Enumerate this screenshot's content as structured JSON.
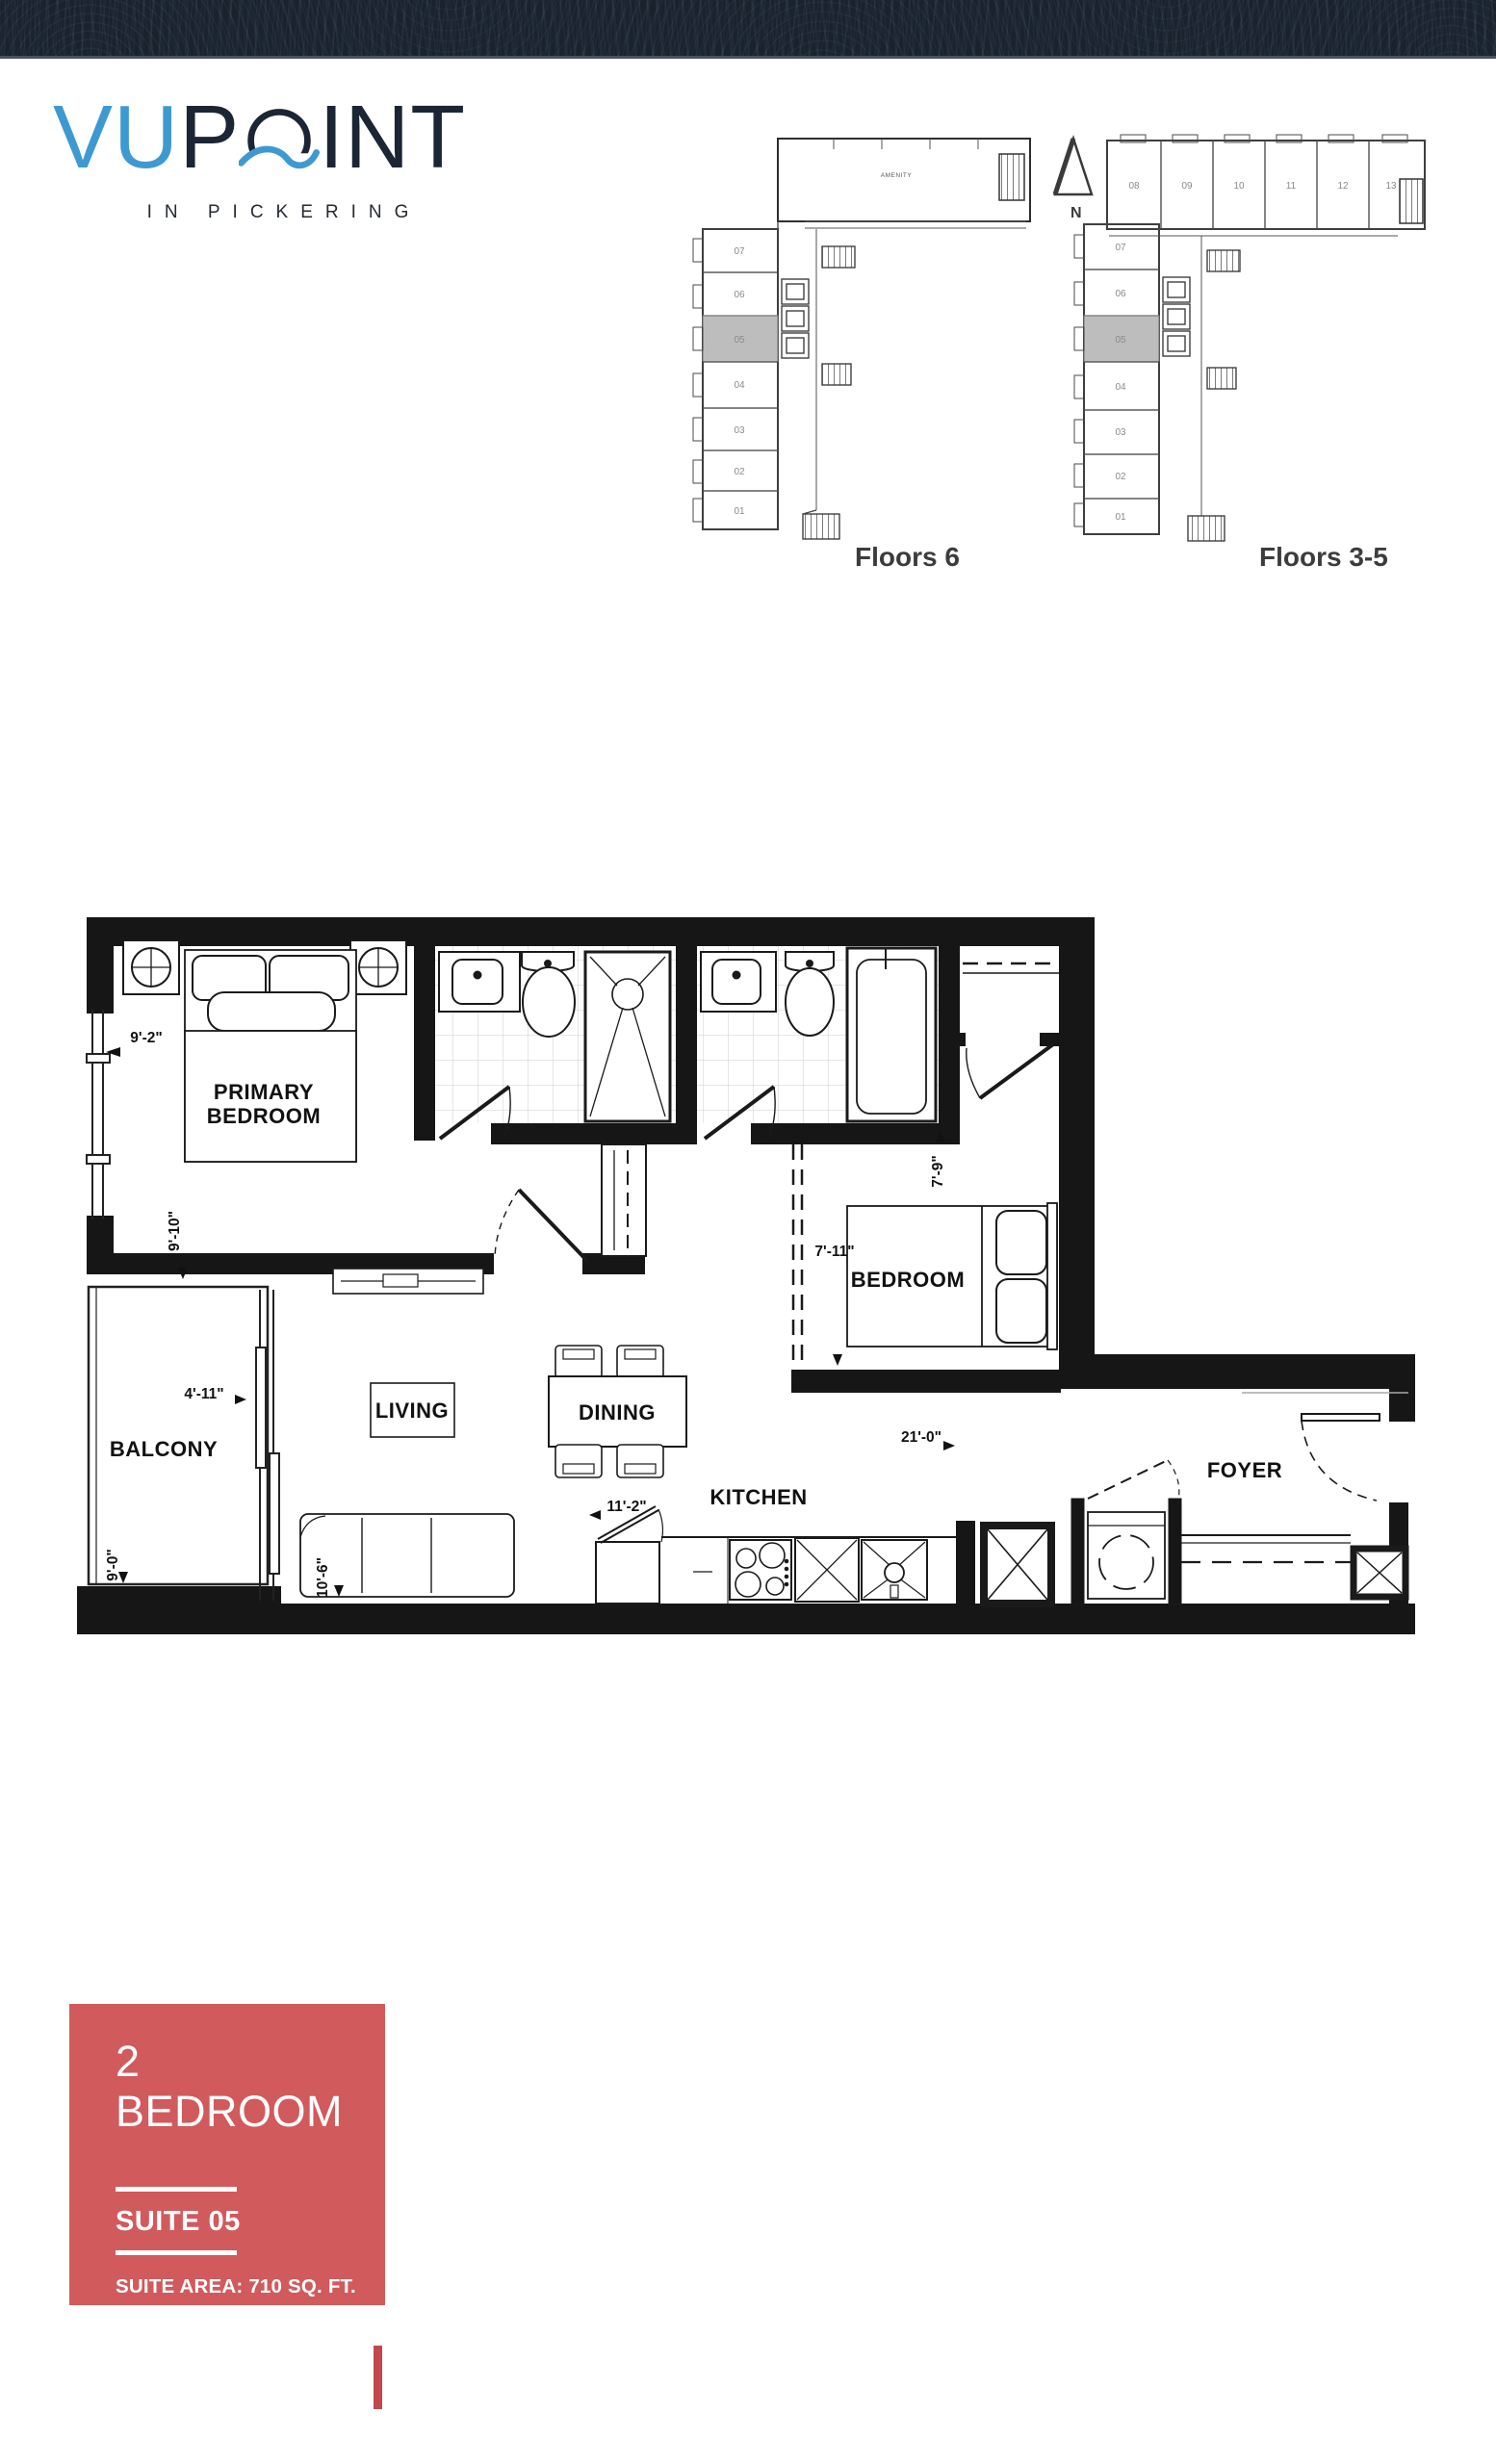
{
  "page": {
    "background": "#ffffff",
    "topbar_color": "#19222d"
  },
  "logo": {
    "vu": "VU",
    "p": "P",
    "int": "INT",
    "tagline": "IN PICKERING",
    "blue": "#3f99d1",
    "dark": "#1b2533"
  },
  "north_arrow": {
    "label": "N"
  },
  "keyplans": [
    {
      "caption": "Floors 6",
      "amenity_label": "AMENITY",
      "left_units": [
        "07",
        "06",
        "05",
        "04",
        "03",
        "02",
        "01"
      ],
      "highlighted_unit": "05"
    },
    {
      "caption": "Floors 3-5",
      "top_units": [
        "08",
        "09",
        "10",
        "11",
        "12",
        "13"
      ],
      "left_units": [
        "07",
        "06",
        "05",
        "04",
        "03",
        "02",
        "01"
      ],
      "highlighted_unit": "05"
    }
  ],
  "floorplan": {
    "rooms": {
      "primary_bedroom_line1": "PRIMARY",
      "primary_bedroom_line2": "BEDROOM",
      "bedroom": "BEDROOM",
      "living": "LIVING",
      "dining": "DINING",
      "kitchen": "KITCHEN",
      "balcony": "BALCONY",
      "foyer": "FOYER"
    },
    "dimensions": {
      "primary_width": "9'-2\"",
      "primary_depth": "9'-10\"",
      "bedroom_depth": "7'-9\"",
      "bedroom_width": "7'-11\"",
      "balcony_width": "4'-11\"",
      "balcony_depth": "9'-0\"",
      "living_width": "10'-6\"",
      "kitchen_width": "11'-2\"",
      "suite_width": "21'-0\""
    }
  },
  "info_card": {
    "type_label": "2 BEDROOM",
    "suite_label": "SUITE 05",
    "area_line": "SUITE AREA: 710 SQ. FT.",
    "balcony_line": "BALCONY: 45 SQ. FT.",
    "background": "#d15a5c",
    "accent": "#c2484d"
  },
  "highlight_color": "#bdbdbd"
}
